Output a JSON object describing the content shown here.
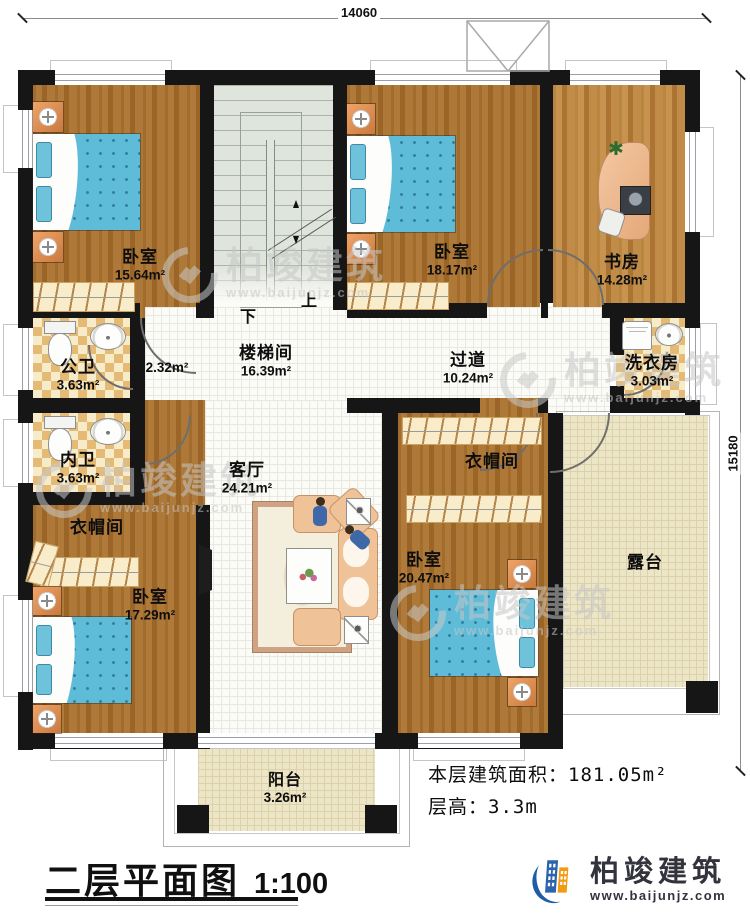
{
  "title": {
    "text": "二层平面图",
    "scale": "1:100"
  },
  "info": {
    "area_label": "本层建筑面积：",
    "area_value": "181.05m²",
    "height_label": "层高：",
    "height_value": "3.3m"
  },
  "brand": {
    "name": "柏竣建筑",
    "website": "www.baijunjz.com"
  },
  "dimensions": {
    "width": "14060",
    "height": "15180"
  },
  "stairs": {
    "up": "上",
    "down": "下"
  },
  "rooms": {
    "bedroom_tl": {
      "name": "卧室",
      "area": "15.64m²"
    },
    "stairwell": {
      "name": "楼梯间",
      "area": "16.39m²"
    },
    "bedroom_tm": {
      "name": "卧室",
      "area": "18.17m²"
    },
    "study": {
      "name": "书房",
      "area": "14.28m²"
    },
    "public_bath": {
      "name": "公卫",
      "area": "3.63m²"
    },
    "vestibule": {
      "area": "2.32m²"
    },
    "corridor": {
      "name": "过道",
      "area": "10.24m²"
    },
    "laundry": {
      "name": "洗衣房",
      "area": "3.03m²"
    },
    "inner_bath": {
      "name": "内卫",
      "area": "3.63m²"
    },
    "cloakroom_left": {
      "name": "衣帽间"
    },
    "cloakroom_right": {
      "name": "衣帽间"
    },
    "living": {
      "name": "客厅",
      "area": "24.21m²"
    },
    "bedroom_bl": {
      "name": "卧室",
      "area": "17.29m²"
    },
    "bedroom_br": {
      "name": "卧室",
      "area": "20.47m²"
    },
    "terrace": {
      "name": "露台"
    },
    "balcony": {
      "name": "阳台",
      "area": "3.26m²"
    }
  },
  "colors": {
    "wall": "#161616",
    "wood": "#a9743a",
    "tile": "#fbfbf8",
    "checker": "#e5ba74",
    "stair": "#dfe4dc",
    "terrace": "#ede6c6",
    "bed": "#5fbcd8",
    "brand_blue": "#1e5ca6",
    "brand_orange": "#f29a11"
  }
}
